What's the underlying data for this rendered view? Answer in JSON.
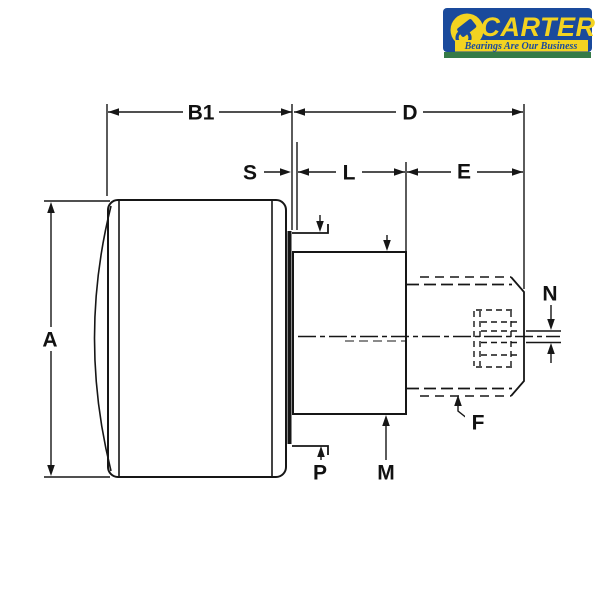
{
  "logo": {
    "brand": "CARTER",
    "tagline": "Bearings Are Our Business",
    "colors": {
      "blue": "#1a4a9c",
      "yellow": "#f3d321",
      "green": "#357a47"
    }
  },
  "drawing": {
    "colors": {
      "ink": "#161616",
      "background": "#ffffff"
    },
    "labels": {
      "A": "A",
      "B1": "B1",
      "D": "D",
      "S": "S",
      "L": "L",
      "E": "E",
      "N": "N",
      "P": "P",
      "M": "M",
      "F": "F"
    }
  }
}
